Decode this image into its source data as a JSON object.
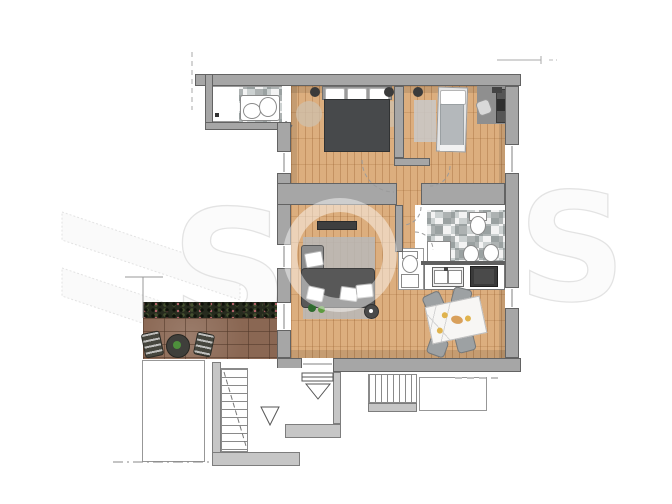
{
  "scene": {
    "kind": "apartment-floor-plan",
    "style": "top-down 3D rendered plan on white scanned page",
    "page": {
      "width": 672,
      "height": 504
    }
  },
  "watermark": {
    "letter_left": "S",
    "letter_right": "S",
    "style": "large pale outlined letters and diagonal logo bands behind/over the plan"
  },
  "palette": {
    "paper": "#ffffff",
    "wood": "#dcae7e",
    "wall": "#a6a6a6",
    "wall_edge": "#636363",
    "wall_light": "#c6c6c6",
    "tile_a": "#f3f3f3",
    "tile_b": "#ccd1d1",
    "terrace_brick": "#8a6753",
    "hedge": "#262b1e",
    "hedge_dot": "#b4636a",
    "sofa": "#585858",
    "sofa_light": "#8d8d8d",
    "bed": "#47494b",
    "bed_head": "#9a9a9a",
    "rug": "#b9b9b9",
    "rug_warm": "#cfc0ae",
    "stove": "#3a3a3a",
    "chair": "#9da1a3",
    "marble": "#f7f6f4",
    "marble_vein": "#d4d4d4",
    "plant_green": "#4e8f3c",
    "accent_yellow": "#e0b34d",
    "watermark_fill": "#fbfbfb",
    "watermark_edge": "#e3e3e3",
    "outline_thin": "#979797"
  },
  "rooms": [
    {
      "name": "small-bathroom-top",
      "features": [
        "checkerboard-tiles",
        "washbasin-ovals",
        "white-console"
      ]
    },
    {
      "name": "master-bedroom",
      "features": [
        "double-bed-dark",
        "three-pillows",
        "round-bedside-rugs",
        "bedside-dots"
      ]
    },
    {
      "name": "kids-room",
      "features": [
        "single-bed",
        "light-rug",
        "desk",
        "desk-chair",
        "laptop"
      ]
    },
    {
      "name": "hallway",
      "features": [
        "door-swing-arcs",
        "wall-stub"
      ]
    },
    {
      "name": "living-room",
      "features": [
        "corner-sofa",
        "gray-rug",
        "tv-sideboard",
        "round-side-table",
        "plants"
      ]
    },
    {
      "name": "main-bathroom",
      "features": [
        "checkerboard-tiles",
        "toilet",
        "two-basin-ovals",
        "shower-tray"
      ]
    },
    {
      "name": "wc-niche",
      "features": [
        "toilet",
        "small-sink"
      ]
    },
    {
      "name": "kitchen",
      "features": [
        "white-counter",
        "double-sink",
        "dark-stove"
      ]
    },
    {
      "name": "dining-area",
      "features": [
        "marble-table",
        "four-gray-chairs",
        "yellow-plates"
      ]
    },
    {
      "name": "terrace",
      "features": [
        "dark-hedge",
        "brick-paving",
        "two-lounge-chairs",
        "round-table"
      ]
    },
    {
      "name": "stairwell",
      "features": [
        "stair-flight-left",
        "stair-flight-right",
        "entrance-threshold",
        "direction-triangles",
        "dash-dot-boundary"
      ]
    }
  ]
}
